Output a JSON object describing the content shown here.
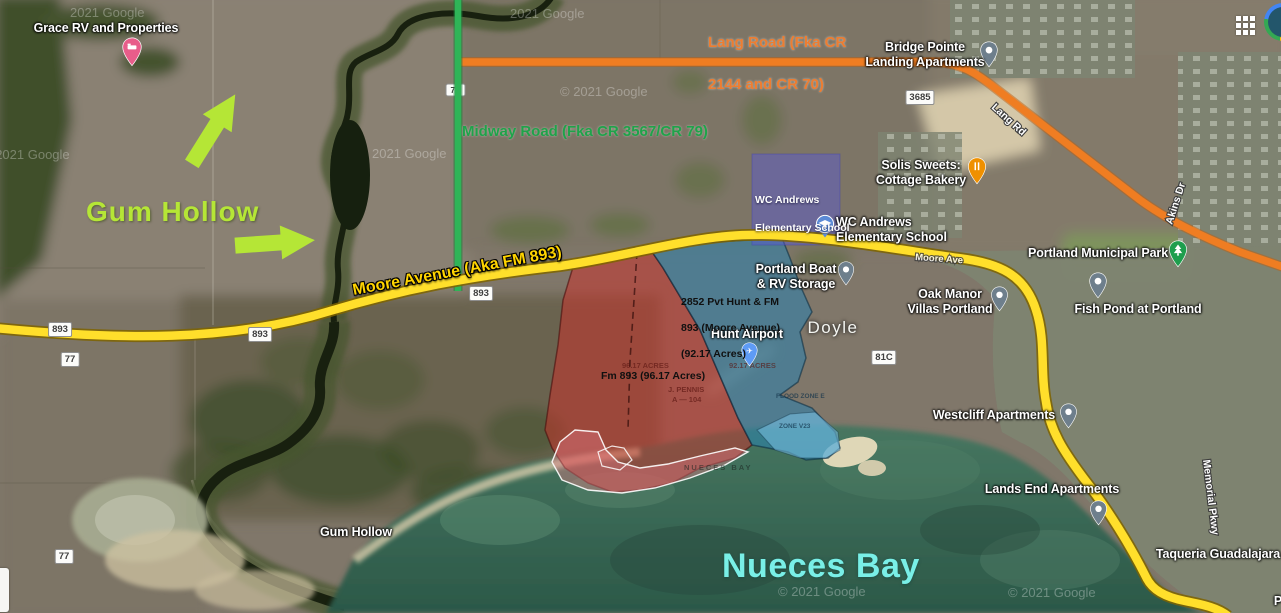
{
  "attribution": {
    "watermark_full": "© 2021 Google",
    "watermark_short": "2021 Google"
  },
  "annotations": {
    "gum_hollow": "Gum Hollow",
    "lang_road": {
      "line1": "Lang Road (Fka CR",
      "line2": "2144 and CR 70)"
    },
    "midway_road": "Midway Road (Fka CR 3567/CR 79)",
    "moore_avenue": "Moore Avenue (Aka FM 893)",
    "school_overlay": {
      "line1": "WC Andrews",
      "line2": "Elementary School"
    },
    "parcel_blue": {
      "line1": "2852 Pvt Hunt & FM",
      "line2": "893 (Moore Avenue)",
      "line3": "(92.17 Acres)"
    },
    "parcel_red": "Fm 893 (96.17 Acres)",
    "nueces_bay": "Nueces Bay"
  },
  "plat_texts": {
    "red_acres": "96.17 ACRES",
    "blue_acres": "92.17 ACRES",
    "pennis1": "J. PENNIS",
    "pennis2": "A — 104",
    "flood": "FLOOD ZONE E",
    "zone": "ZONE V23",
    "bay_stencil": "NUECES BAY"
  },
  "places": {
    "grace_rv": "Grace RV and Properties",
    "bridge_pointe": {
      "line1": "Bridge Pointe",
      "line2": "Landing Apartments"
    },
    "solis": {
      "line1": "Solis Sweets:",
      "line2": "Cottage Bakery"
    },
    "wc_andrews": {
      "line1": "WC Andrews",
      "line2": "Elementary School"
    },
    "boat_storage": {
      "line1": "Portland Boat",
      "line2": "& RV Storage"
    },
    "oak_manor": {
      "line1": "Oak Manor",
      "line2": "Villas Portland"
    },
    "municipal_park": "Portland Municipal Park",
    "fish_pond": "Fish Pond at Portland",
    "hunt_airport": "Hunt Airport",
    "doyle": "Doyle",
    "westcliff": "Westcliff Apartments",
    "lands_end": "Lands End Apartments",
    "taqueria": "Taqueria Guadalajara",
    "gum_hollow_place": "Gum Hollow",
    "partial_label": "P"
  },
  "road_labels": {
    "lang_rd": "Lang Rd",
    "akins_dr": "Akins Dr",
    "memorial_pkwy": "Memorial Pkwy",
    "moore_ave": "Moore Ave"
  },
  "shields": {
    "s893": "893",
    "s77": "77",
    "s3685": "3685",
    "s81c": "81C",
    "s79": "79"
  },
  "colors": {
    "annotation_gum": "#b5e636",
    "annotation_lang": "#ed7d31",
    "annotation_midway": "#1fa34a",
    "annotation_moore": "#ffd400",
    "annotation_bay": "#79efe7",
    "parcel_red_fill": "#cd2d28",
    "parcel_blue_fill": "#2882af",
    "school_overlay_fill": "#5a5ad2",
    "road_yellow": "#ffdf2b",
    "road_orange": "#ef7d22",
    "road_green": "#2fb457"
  }
}
